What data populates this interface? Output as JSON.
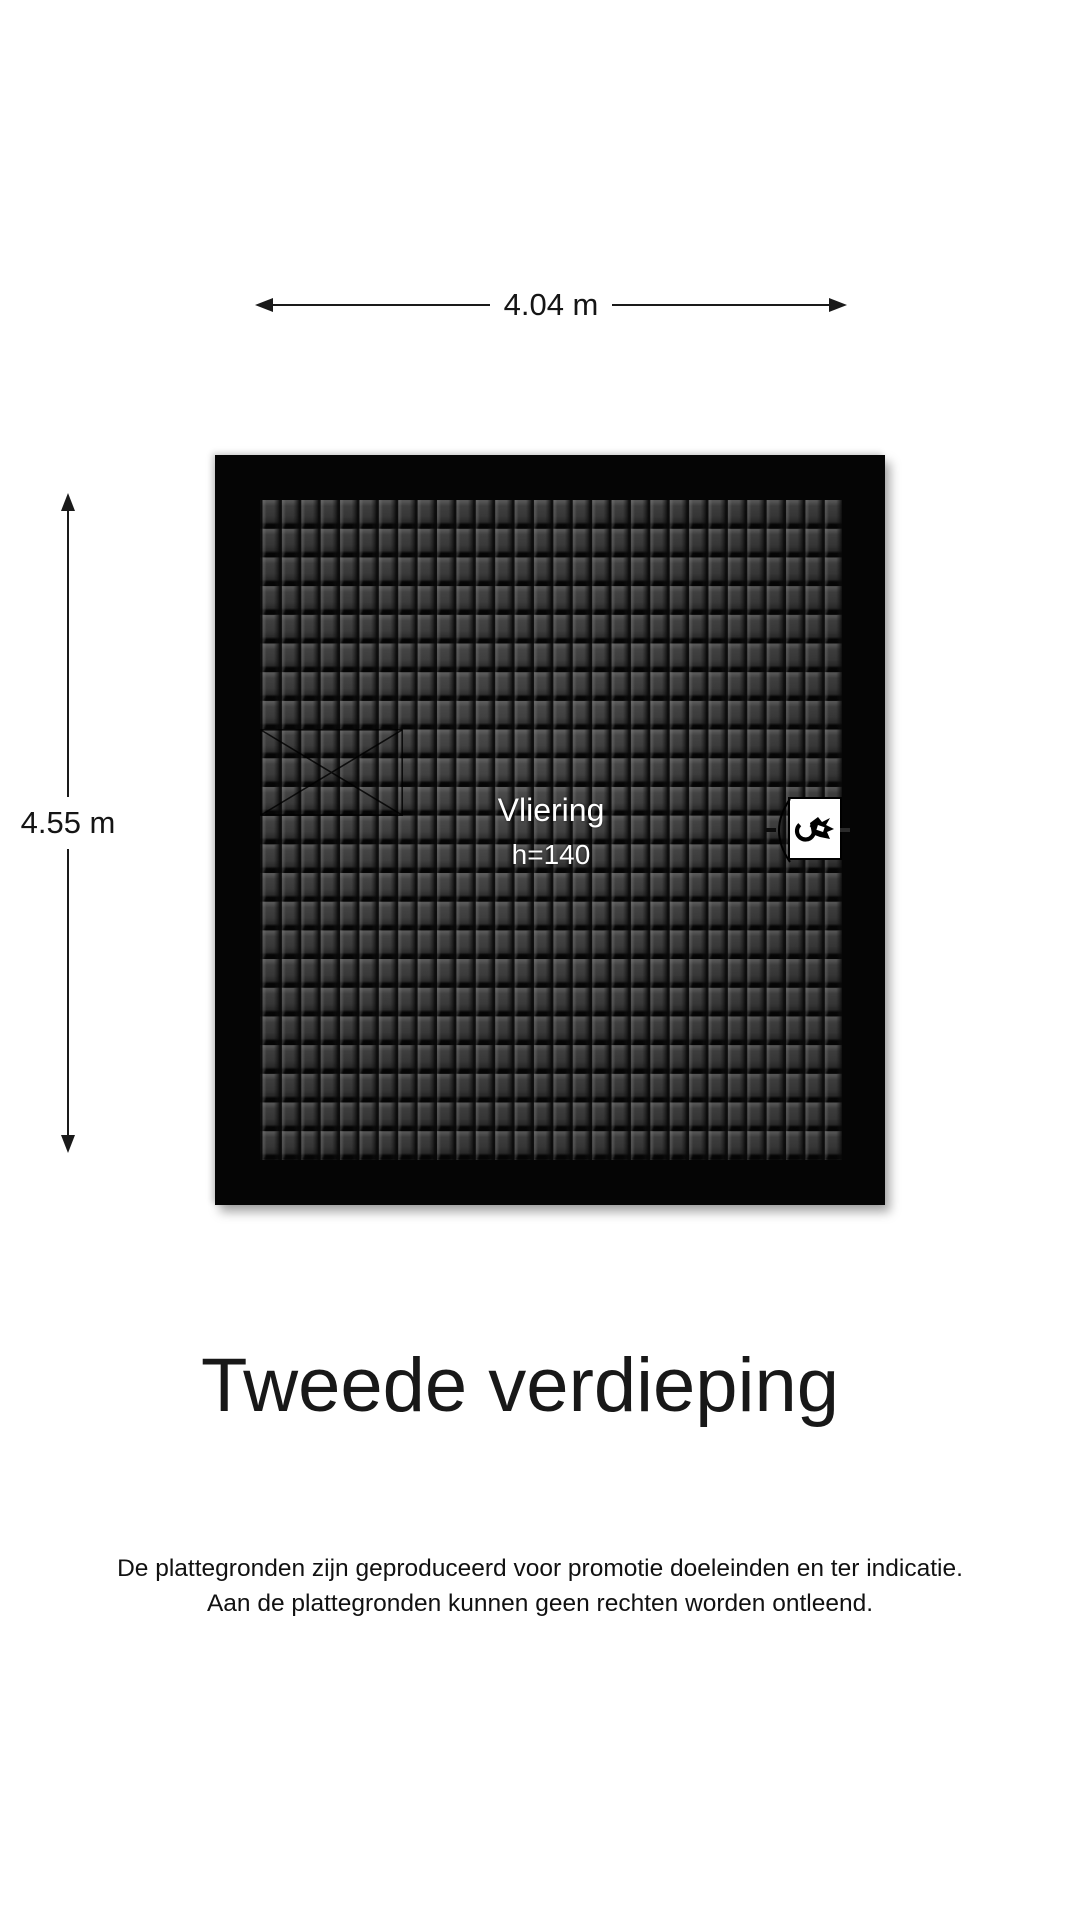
{
  "page": {
    "title": "Tweede verdieping",
    "disclaimer_line1": "De plattegronden zijn geproduceerd voor promotie doeleinden en ter indicatie.",
    "disclaimer_line2": "Aan de plattegronden kunnen geen rechten worden ontleend."
  },
  "floorplan": {
    "room": {
      "name": "Vliering",
      "height_label": "h=140"
    },
    "dimensions": {
      "width_label": "4.04 m",
      "height_label": "4.55 m"
    },
    "fixtures": [
      {
        "name": "boiler-unit",
        "icon": "tap-icon"
      },
      {
        "name": "roof-hatch",
        "icon": "crossed-rectangle"
      }
    ],
    "colors": {
      "wall": "#050505",
      "roof_tile": "#3d3d3d",
      "background": "#ffffff",
      "room_label_text": "#ffffff",
      "dimension_text": "#151515"
    }
  }
}
